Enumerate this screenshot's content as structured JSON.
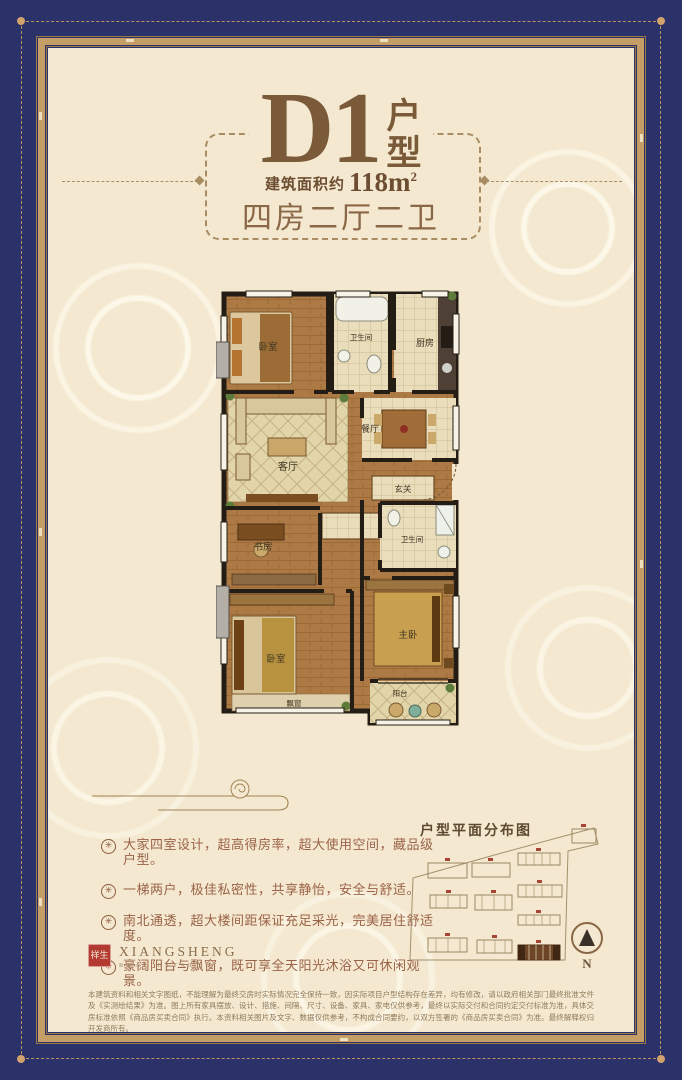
{
  "colors": {
    "navy": "#2b3169",
    "gold": "#c59d66",
    "cream": "#f4e9d0",
    "title_brown": "#7a5a38",
    "feature_text": "#9a6248",
    "seal_red": "#b23a31"
  },
  "header": {
    "unit_code": "D1",
    "unit_type_label": "户型",
    "area_label": "建筑面积约",
    "area_value": "118m",
    "area_sup": "2",
    "rooms_summary": "四房二厅二卫"
  },
  "floorplan": {
    "rooms": [
      {
        "label": "卧室"
      },
      {
        "label": "卫生间"
      },
      {
        "label": "厨房"
      },
      {
        "label": "客厅"
      },
      {
        "label": "餐厅"
      },
      {
        "label": "玄关"
      },
      {
        "label": "书房"
      },
      {
        "label": "卫生间"
      },
      {
        "label": "卧室"
      },
      {
        "label": "飘窗"
      },
      {
        "label": "主卧"
      },
      {
        "label": "阳台"
      }
    ]
  },
  "features": {
    "bullet_glyph": "✳",
    "items": [
      "大家四室设计，超高得房率，超大使用空间，藏品级户型。",
      "一梯两户，极佳私密性，共享静怡，安全与舒适。",
      "南北通透，超大楼间距保证充足采光，完美居住舒适度。",
      "豪阔阳台与飘窗，既可享全天阳光沐浴又可休闲观景。"
    ]
  },
  "site_plan": {
    "title": "户型平面分布图",
    "compass_label": "N"
  },
  "logo": {
    "seal_text": "祥生",
    "name": "XIANGSHENG",
    "subtitle": "REAL ESTATE"
  },
  "disclaimer": "本建筑资料和相关文字图纸，不能理解为最终交房时实际情况完全保持一致，因实际项目户型结构存在差异，均有修改，请以政府相关部门最终批准文件及《实测绘结果》为准。图上所有家具摆放、设计、措施、间隔、尺寸、设备、家具、家电仅供参考，最终以实际交付和合同约定交付标准为准，具体交房标准依照《商品房买卖合同》执行。本资料相关图片及文字、数据仅供参考，不构成合同要约，以双方签署的《商品房买卖合同》为准。最终解释权归开发商所有。"
}
